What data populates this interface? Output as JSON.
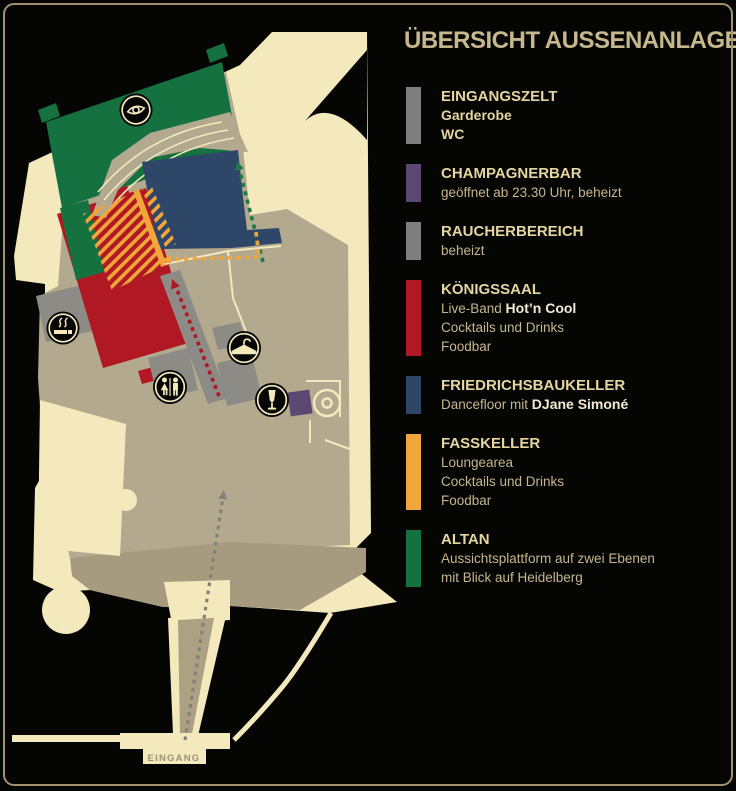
{
  "title": "ÜBERSICHT AUSSENANLAGE",
  "map": {
    "entrance_label": "EINGANG",
    "icons": [
      "eye-viewpoint-icon",
      "smoking-icon",
      "wc-icon",
      "wardrobe-hanger-icon",
      "champagne-glass-icon",
      "castle-well-icon"
    ],
    "areas": [
      "Altan",
      "Friedrichsbaukeller",
      "Königssaal",
      "Fasskeller",
      "Raucherbereich",
      "Champagnerbar",
      "Eingangszelt"
    ]
  },
  "colors": {
    "background": "#050504",
    "frame": "#a09270",
    "castle_cream": "#f3e9bd",
    "courtyard": "#b3a98f",
    "courtyard_dark": "#a69b7f",
    "walkway_gray": "#8d8b85",
    "red": "#b01823",
    "blue": "#2e4668",
    "green": "#15713f",
    "orange": "#f1a63b",
    "purple": "#5c4973",
    "swatch_gray": "#7e7e80",
    "title_text": "#c7b78d",
    "header_text": "#e5d5a0",
    "body_text": "#c6b68d",
    "emphasis_text": "#f3ecd4"
  },
  "legend": {
    "entries": [
      {
        "title": "EINGANGSZELT",
        "color": "#7e7e80",
        "lines": [
          [
            {
              "t": "Garderobe",
              "s": "g"
            }
          ],
          [
            {
              "t": "WC",
              "s": "g"
            }
          ]
        ]
      },
      {
        "title": "CHAMPAGNERBAR",
        "color": "#5c4973",
        "lines": [
          [
            {
              "t": "geöffnet ab 23.30 Uhr, beheizt",
              "s": "n"
            }
          ]
        ]
      },
      {
        "title": "RAUCHERBEREICH",
        "color": "#7e7e80",
        "lines": [
          [
            {
              "t": "beheizt",
              "s": "n"
            }
          ]
        ]
      },
      {
        "title": "KÖNIGSSAAL",
        "color": "#b01823",
        "lines": [
          [
            {
              "t": "Live-Band ",
              "s": "n"
            },
            {
              "t": "Hot’n Cool",
              "s": "w"
            }
          ],
          [
            {
              "t": "Cocktails und Drinks",
              "s": "n"
            }
          ],
          [
            {
              "t": "Foodbar",
              "s": "n"
            }
          ]
        ]
      },
      {
        "title": "FRIEDRICHSBAUKELLER",
        "color": "#2e4668",
        "lines": [
          [
            {
              "t": "Dancefloor mit ",
              "s": "n"
            },
            {
              "t": "DJane Simoné",
              "s": "w"
            }
          ]
        ]
      },
      {
        "title": "FASSKELLER",
        "color": "#f1a63b",
        "lines": [
          [
            {
              "t": "Loungearea",
              "s": "n"
            }
          ],
          [
            {
              "t": "Cocktails und Drinks",
              "s": "n"
            }
          ],
          [
            {
              "t": "Foodbar",
              "s": "n"
            }
          ]
        ]
      },
      {
        "title": "ALTAN",
        "color": "#15713f",
        "lines": [
          [
            {
              "t": "Aussichtsplattform auf zwei Ebenen",
              "s": "n"
            }
          ],
          [
            {
              "t": "mit Blick auf Heidelberg",
              "s": "n"
            }
          ]
        ]
      }
    ]
  }
}
